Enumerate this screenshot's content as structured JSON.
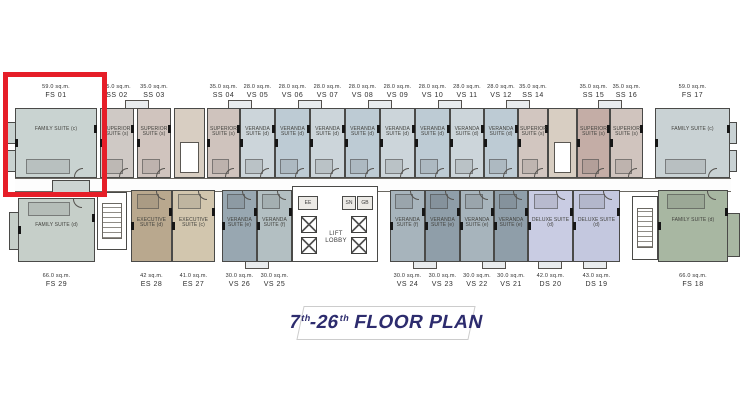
{
  "title": {
    "num1": "7",
    "sup1": "th",
    "num2": "-26",
    "sup2": "th",
    "text": "FLOOR PLAN"
  },
  "colors": {
    "highlight_red": "#e61e28",
    "title_navy": "#2d2c6e",
    "wall": "#4a4a48"
  },
  "core": {
    "lift_lobby": "LIFT LOBBY",
    "room_ee": "EE",
    "room_sn": "SN",
    "room_gb": "GB"
  },
  "top_units": [
    {
      "code": "FS 01",
      "area": "59.0 sq.m.",
      "name": "FAMILY SUITE (c)",
      "fill": "#c9d3d1"
    },
    {
      "code": "SS 02",
      "area": "35.0 sq.m.",
      "name": "SUPERIOR SUITE (s)",
      "fill": "#cfc9c5"
    },
    {
      "code": "SS 03",
      "area": "35.0 sq.m.",
      "name": "SUPERIOR SUITE (s)",
      "fill": "#d0c4be"
    },
    {
      "code": "SS 04",
      "area": "35.0 sq.m.",
      "name": "SUPERIOR SUITE (s)",
      "fill": "#cfc3bd"
    },
    {
      "code": "VS 05",
      "area": "28.0 sq.m.",
      "name": "VERANDA SUITE (d)",
      "fill": "#ccd5da"
    },
    {
      "code": "VS 06",
      "area": "28.0 sq.m.",
      "name": "VERANDA SUITE (d)",
      "fill": "#bdcbd4"
    },
    {
      "code": "VS 07",
      "area": "28.0 sq.m.",
      "name": "VERANDA SUITE (d)",
      "fill": "#ccd5da"
    },
    {
      "code": "VS 08",
      "area": "28.0 sq.m.",
      "name": "VERANDA SUITE (d)",
      "fill": "#bdcbd4"
    },
    {
      "code": "VS 09",
      "area": "28.0 sq.m.",
      "name": "VERANDA SUITE (d)",
      "fill": "#ccd5da"
    },
    {
      "code": "VS 10",
      "area": "28.0 sq.m.",
      "name": "VERANDA SUITE (d)",
      "fill": "#bdcbd4"
    },
    {
      "code": "VS 11",
      "area": "28.0 sq.m.",
      "name": "VERANDA SUITE (d)",
      "fill": "#ccd5da"
    },
    {
      "code": "VS 12",
      "area": "28.0 sq.m.",
      "name": "VERANDA SUITE (d)",
      "fill": "#bdcbd4"
    },
    {
      "code": "SS 14",
      "area": "35.0 sq.m.",
      "name": "SUPERIOR SUITE (s)",
      "fill": "#d2c6c0"
    },
    {
      "code": "SS 15",
      "area": "35.0 sq.m.",
      "name": "SUPERIOR SUITE (s)",
      "fill": "#c4ada6"
    },
    {
      "code": "SS 16",
      "area": "35.0 sq.m.",
      "name": "SUPERIOR SUITE (s)",
      "fill": "#d0c4be"
    },
    {
      "code": "FS 17",
      "area": "59.0 sq.m.",
      "name": "FAMILY SUITE (c)",
      "fill": "#c9d2d4"
    }
  ],
  "bottom_units": [
    {
      "code": "FS 29",
      "area": "66.0 sq.m.",
      "name": "FAMILY SUITE (d)",
      "fill": "#c6cfc9"
    },
    {
      "code": "ES 28",
      "area": "42 sq.m.",
      "name": "EXECUTIVE SUITE (d)",
      "fill": "#b9a88e"
    },
    {
      "code": "ES 27",
      "area": "41.0 sq.m.",
      "name": "EXECUTIVE SUITE (c)",
      "fill": "#d2c6ae"
    },
    {
      "code": "VS 26",
      "area": "30.0 sq.m.",
      "name": "VERANDA SUITE (e)",
      "fill": "#98a7b1"
    },
    {
      "code": "VS 25",
      "area": "30.0 sq.m.",
      "name": "VERANDA SUITE (f)",
      "fill": "#b3bfc2"
    },
    {
      "code": "VS 24",
      "area": "30.0 sq.m.",
      "name": "VERANDA SUITE (f)",
      "fill": "#a7b4bc"
    },
    {
      "code": "VS 23",
      "area": "30.0 sq.m.",
      "name": "VERANDA SUITE (e)",
      "fill": "#8f9ea9"
    },
    {
      "code": "VS 22",
      "area": "30.0 sq.m.",
      "name": "VERANDA SUITE (e)",
      "fill": "#a7b4bc"
    },
    {
      "code": "VS 21",
      "area": "30.0 sq.m.",
      "name": "VERANDA SUITE (e)",
      "fill": "#8f9ea9"
    },
    {
      "code": "DS 20",
      "area": "42.0 sq.m.",
      "name": "DELUXE SUITE (d)",
      "fill": "#c9cce3"
    },
    {
      "code": "DS 19",
      "area": "43.0 sq.m.",
      "name": "DELUXE SUITE (d)",
      "fill": "#c4c8df"
    },
    {
      "code": "FS 18",
      "area": "66.0 sq.m.",
      "name": "FAMILY SUITE (d)",
      "fill": "#a8b7a2"
    }
  ]
}
